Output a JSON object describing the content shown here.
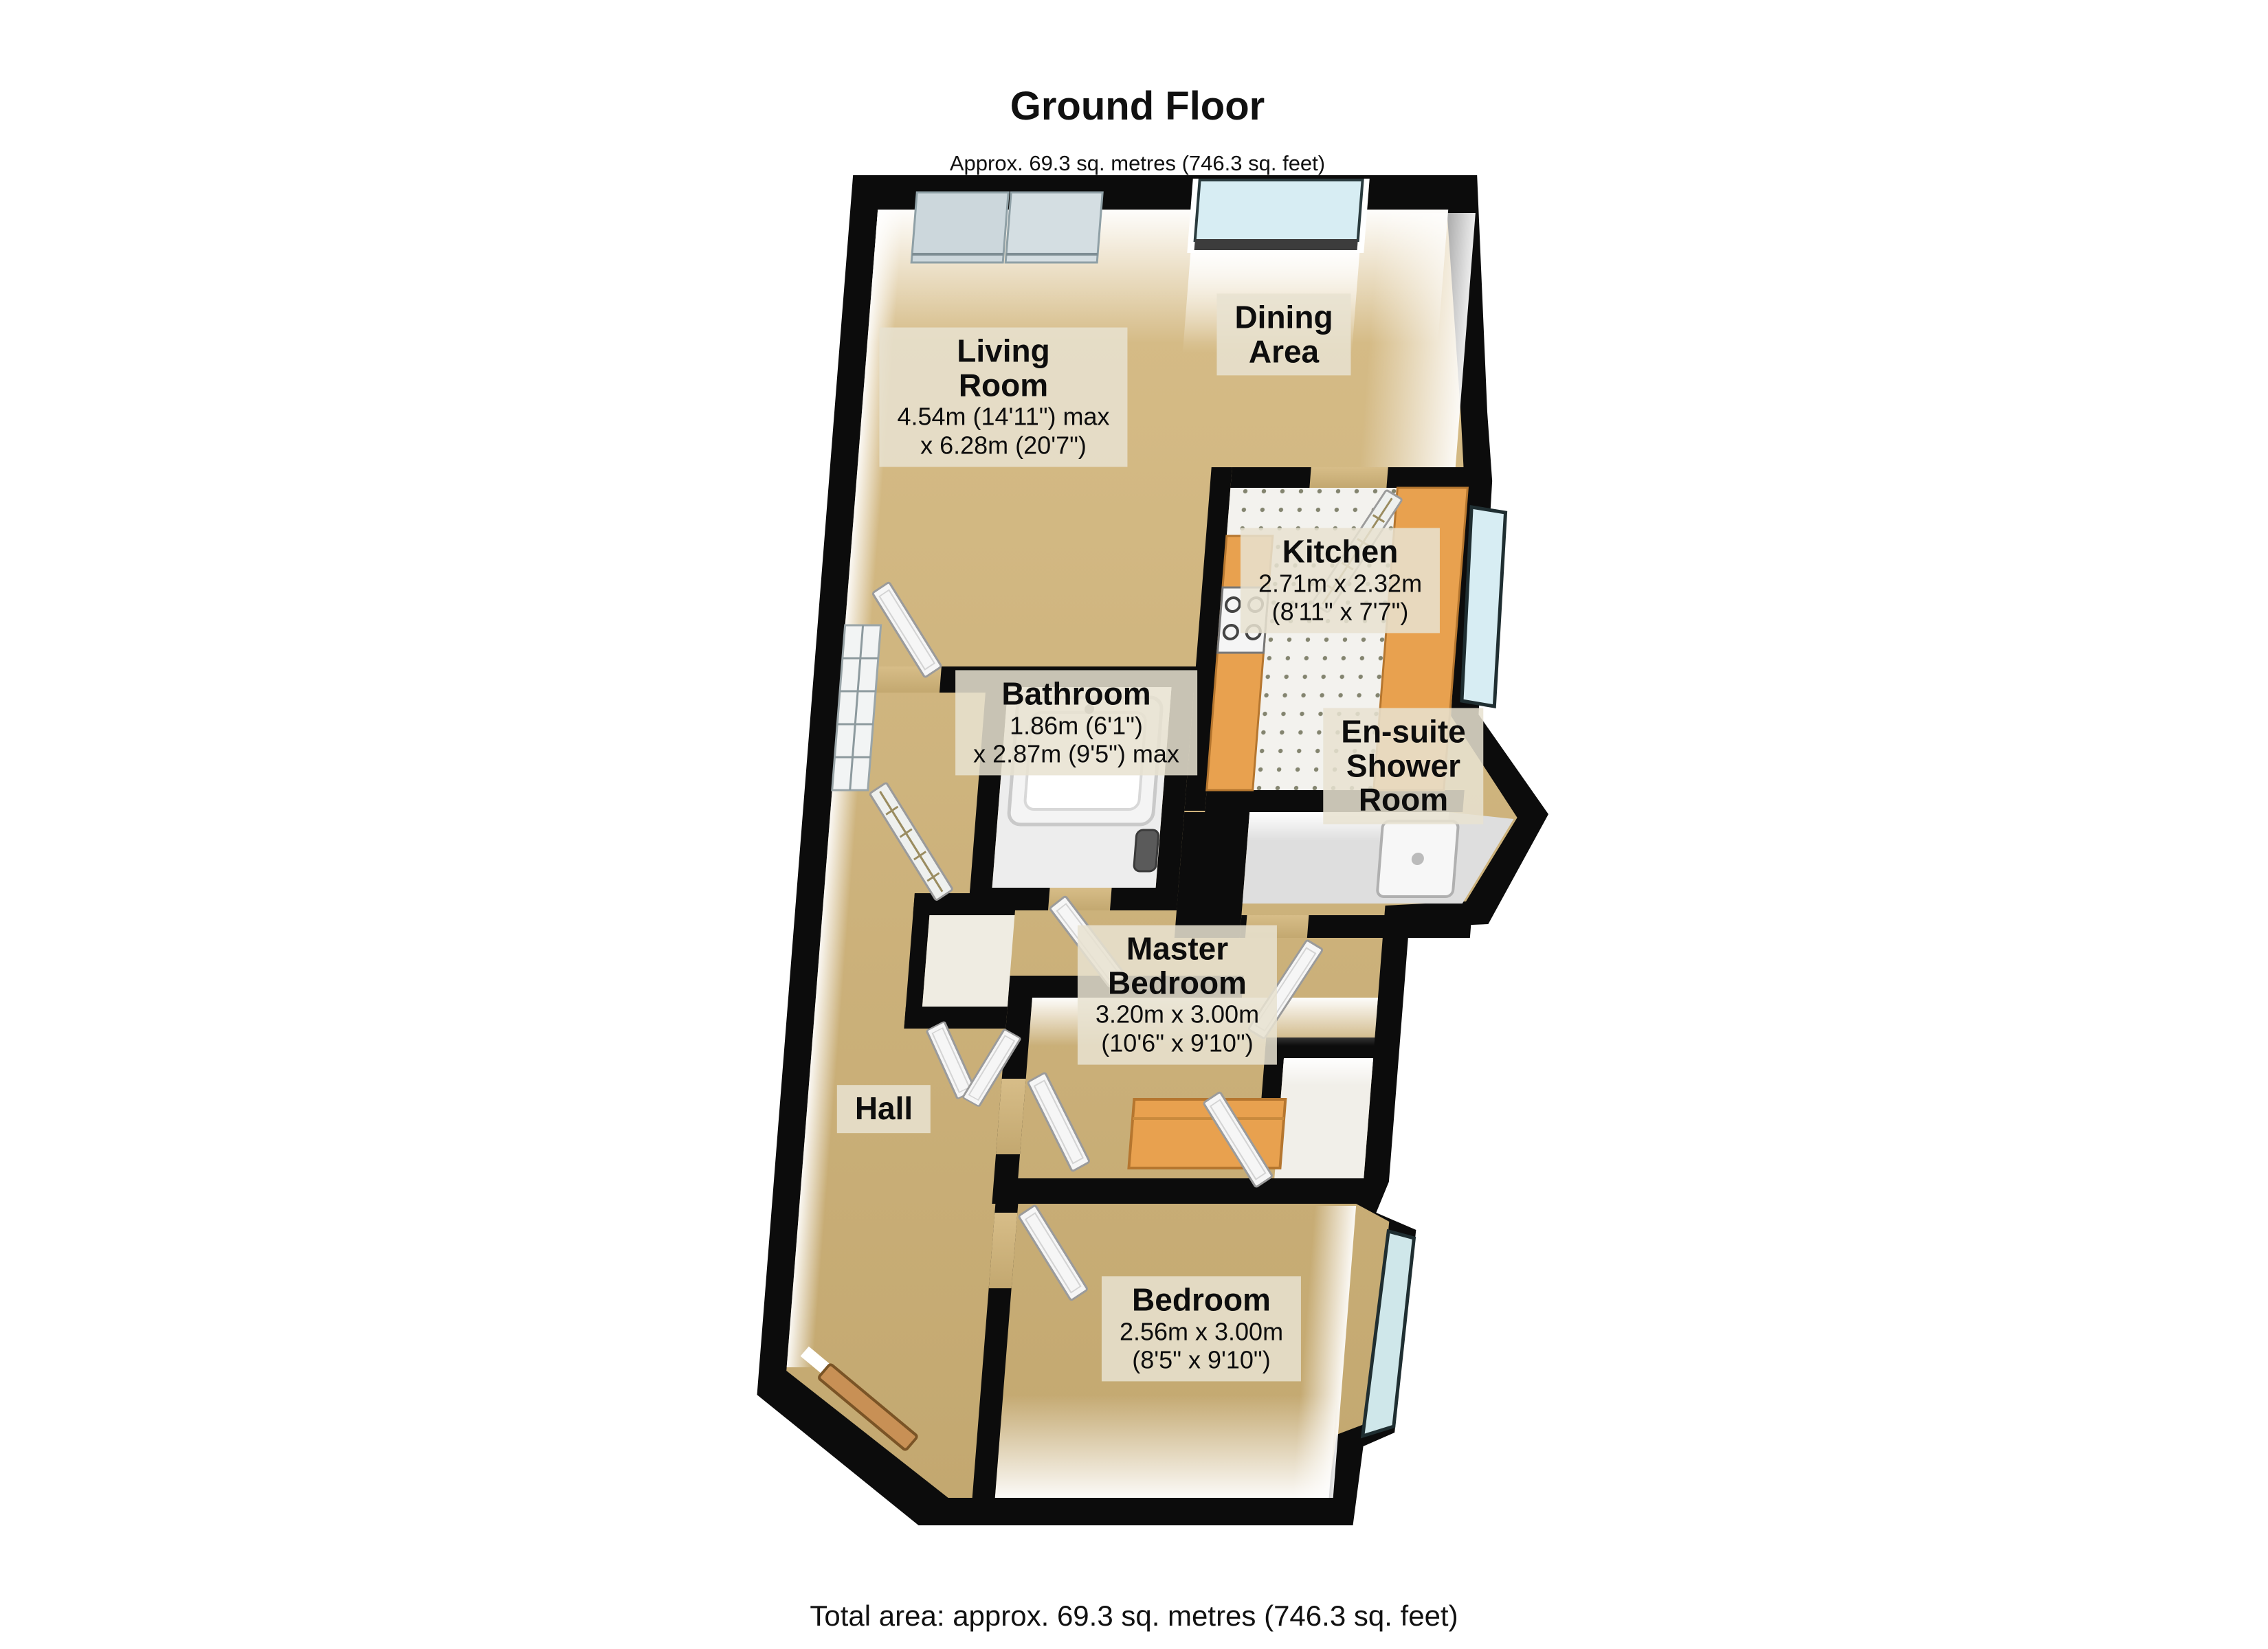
{
  "page": {
    "title_heading": "Ground Floor",
    "title_subtitle": "Approx. 69.3 sq. metres (746.3 sq. feet)",
    "footer_total": "Total area: approx. 69.3 sq. metres (746.3 sq. feet)"
  },
  "rooms": [
    {
      "id": "living-room",
      "name_lines": [
        "Living",
        "Room"
      ],
      "dim_lines": [
        "4.54m (14'11\") max",
        "x 6.28m (20'7\")"
      ]
    },
    {
      "id": "dining-area",
      "name_lines": [
        "Dining",
        "Area"
      ],
      "dim_lines": []
    },
    {
      "id": "kitchen",
      "name_lines": [
        "Kitchen"
      ],
      "dim_lines": [
        "2.71m x 2.32m",
        "(8'11\" x 7'7\")"
      ]
    },
    {
      "id": "bathroom",
      "name_lines": [
        "Bathroom"
      ],
      "dim_lines": [
        "1.86m (6'1\")",
        "x 2.87m (9'5\") max"
      ]
    },
    {
      "id": "en-suite-shower-room",
      "name_lines": [
        "En-suite",
        "Shower",
        "Room"
      ],
      "dim_lines": []
    },
    {
      "id": "master-bedroom",
      "name_lines": [
        "Master",
        "Bedroom"
      ],
      "dim_lines": [
        "3.20m x 3.00m",
        "(10'6\" x 9'10\")"
      ]
    },
    {
      "id": "hall",
      "name_lines": [
        "Hall"
      ],
      "dim_lines": []
    },
    {
      "id": "bedroom",
      "name_lines": [
        "Bedroom"
      ],
      "dim_lines": [
        "2.56m x 3.00m",
        "(8'5\" x 9'10\")"
      ]
    }
  ],
  "colors": {
    "wall": "#0c0c0c",
    "floor_tan": "#cfb47e",
    "floor_tile": "#f3f2ee",
    "counter_orange": "#e8a14f",
    "window_glass": "#d7edf3",
    "label_bg": "#e8e2d0",
    "door_wood": "#c89055"
  }
}
